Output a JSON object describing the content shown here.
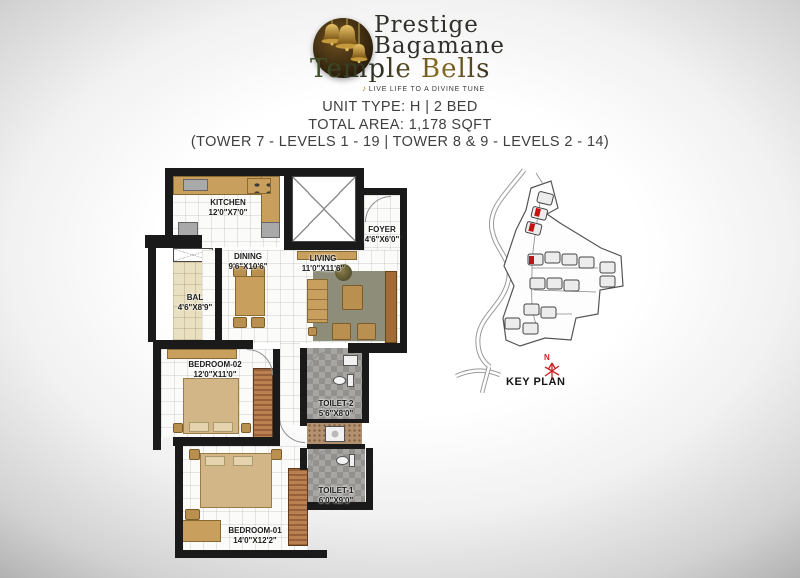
{
  "branding": {
    "name_line1": "Prestige",
    "name_line2": "Bagamane",
    "name_line3": "Temple Bells",
    "tagline": "LIVE LIFE TO A DIVINE TUNE"
  },
  "header": {
    "unit_type": "UNIT TYPE: H | 2 BED",
    "total_area": "TOTAL AREA: 1,178 SQFT",
    "tower_levels": "(TOWER 7 - LEVELS 1 - 19 | TOWER 8 & 9 - LEVELS 2 - 14)"
  },
  "floorplan": {
    "rooms": [
      {
        "name": "KITCHEN",
        "dims": "12'0\"X7'0\""
      },
      {
        "name": "DINING",
        "dims": "9'6\"X10'6\""
      },
      {
        "name": "LIVING",
        "dims": "11'0\"X11'6\""
      },
      {
        "name": "FOYER",
        "dims": "4'6\"X6'0\""
      },
      {
        "name": "BAL",
        "dims": "4'6\"X8'9\""
      },
      {
        "name": "BEDROOM-02",
        "dims": "12'0\"X11'0\""
      },
      {
        "name": "TOILET-2",
        "dims": "5'6\"X8'0\""
      },
      {
        "name": "TOILET-1",
        "dims": "6'0\"X9'0\""
      },
      {
        "name": "BEDROOM-01",
        "dims": "14'0\"X12'2\""
      }
    ]
  },
  "keyplan": {
    "label": "KEY PLAN",
    "north": "N",
    "highlight_color": "#c41111"
  },
  "colors": {
    "wall": "#1a1a1a",
    "counter_tan": "#c99f5d",
    "balcony_floor": "#e9dfc1",
    "accent_red": "#c41111",
    "gold": "#b8860b"
  }
}
